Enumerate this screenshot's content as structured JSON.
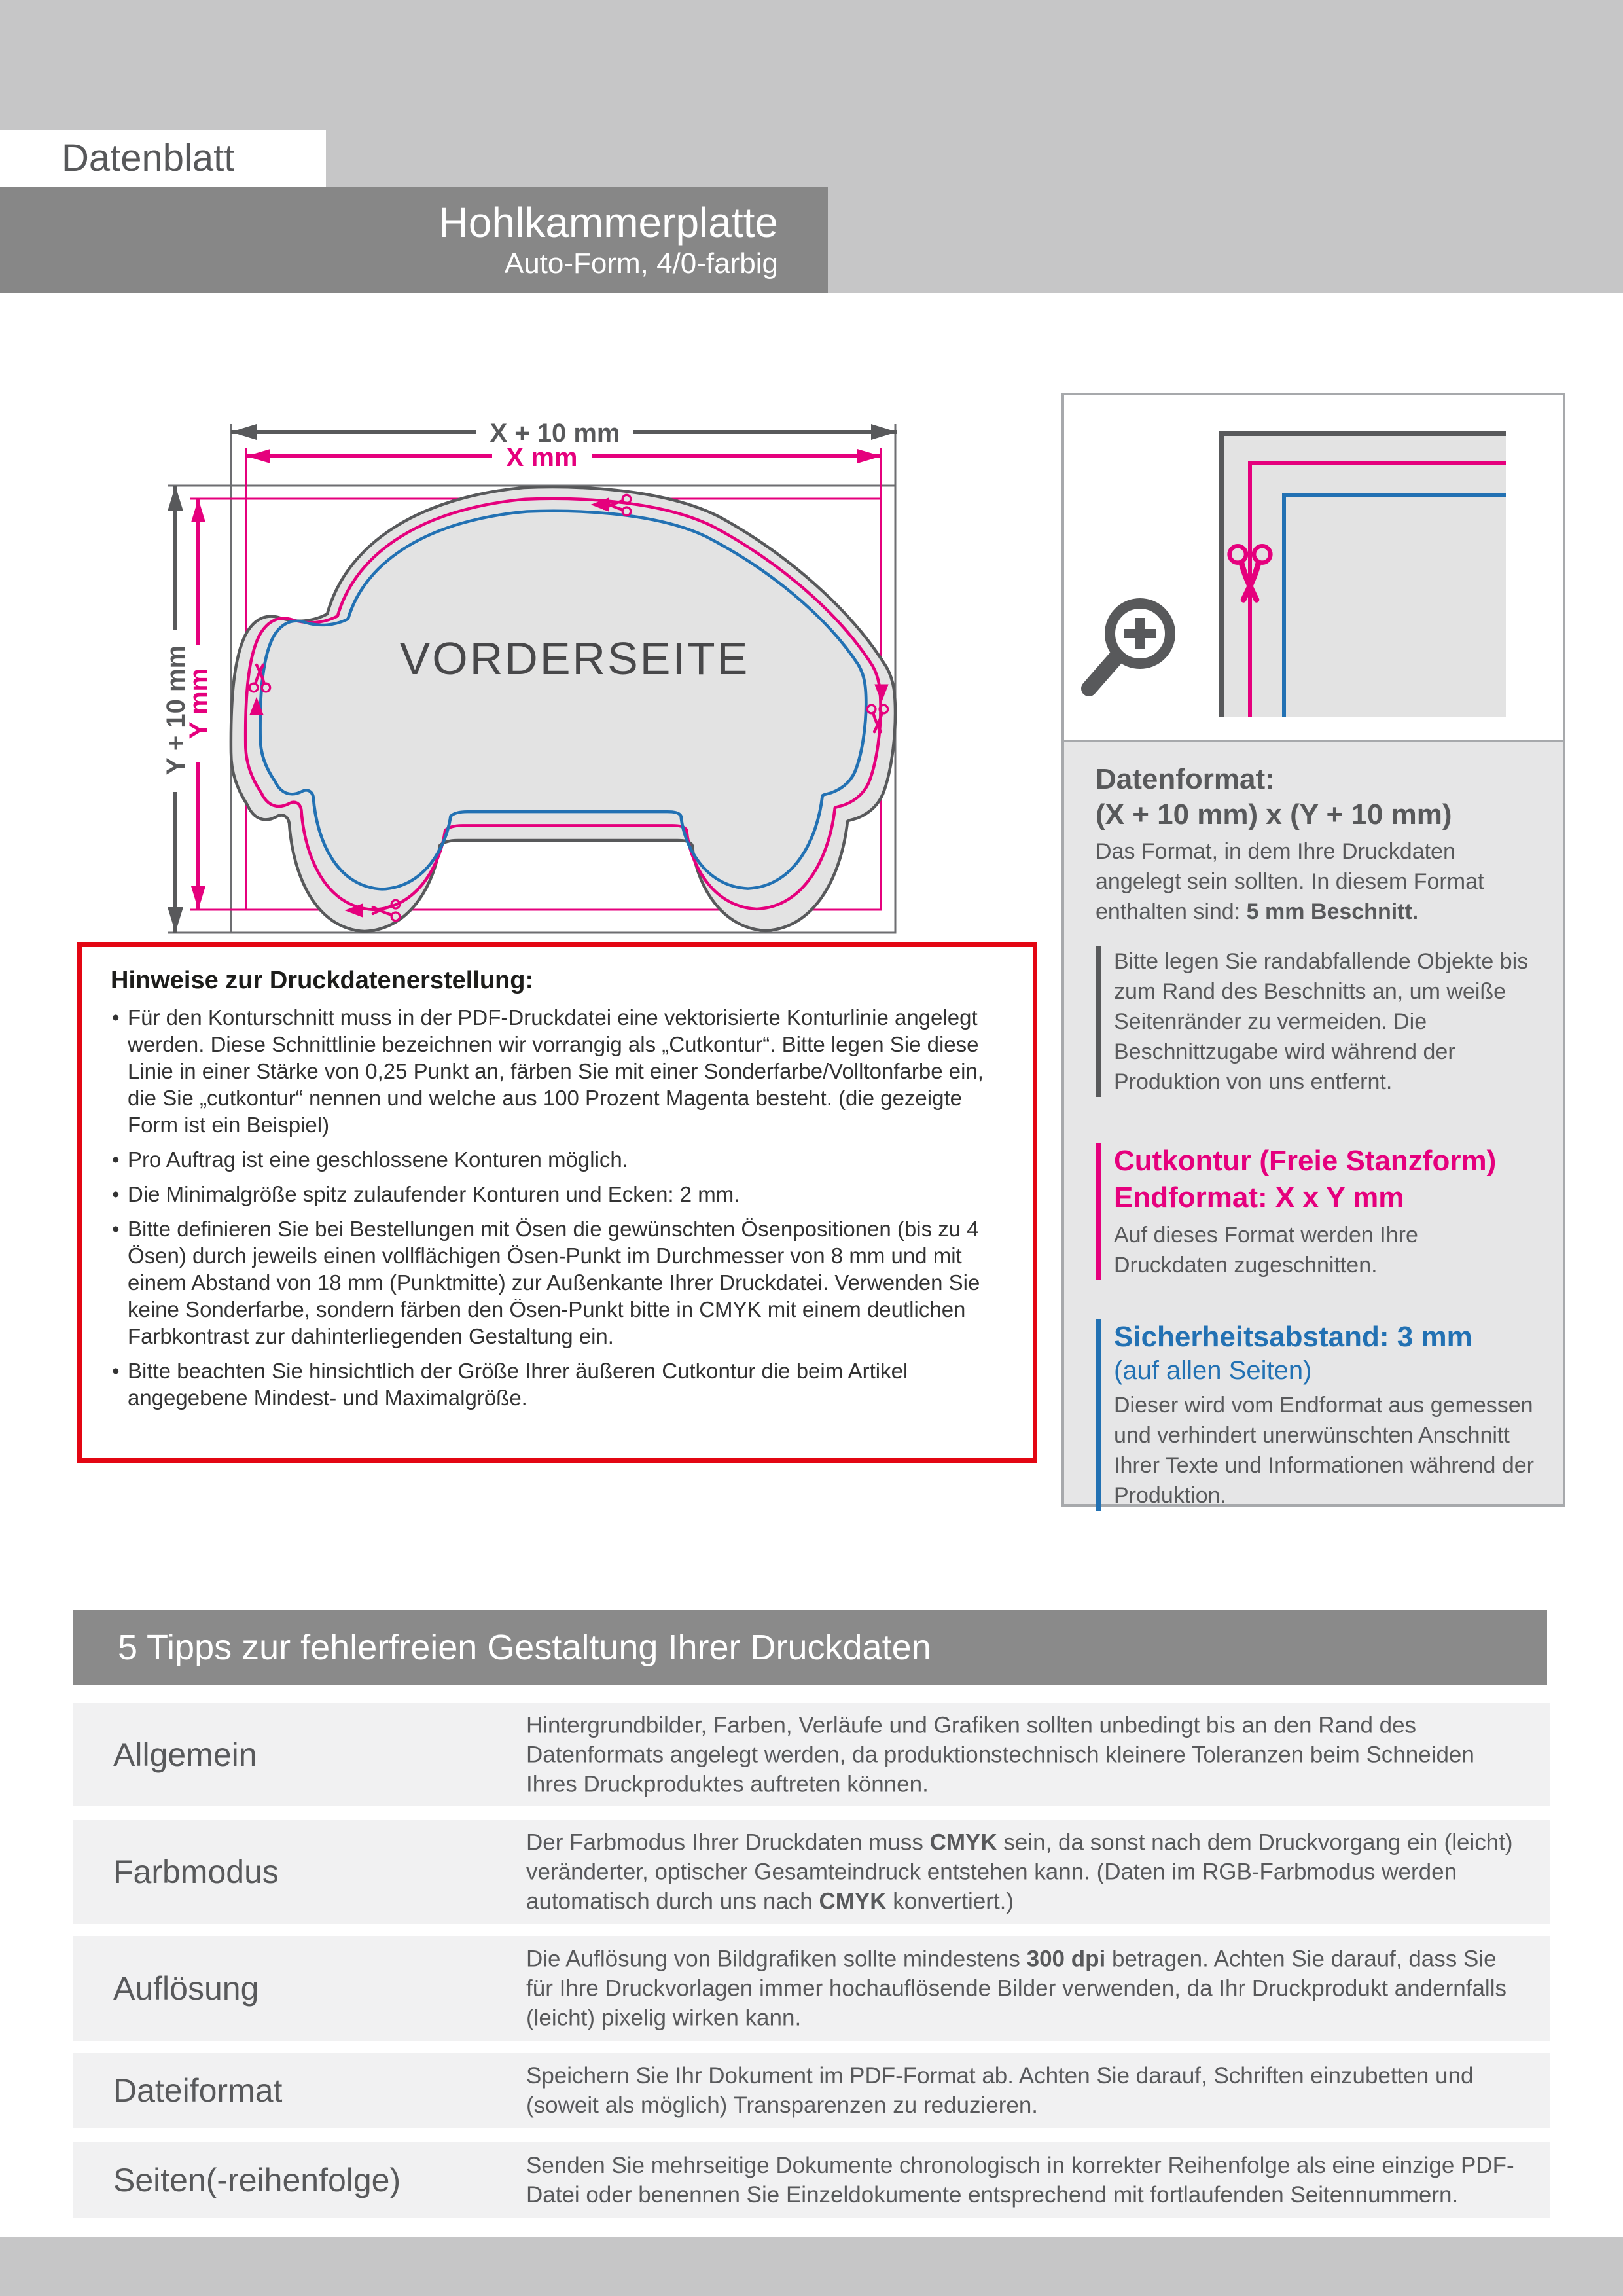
{
  "colors": {
    "magenta": "#e5007d",
    "blue": "#2271b3",
    "dark_gray": "#58595b",
    "band_gray": "#c6c6c7",
    "bar_gray": "#878787",
    "red": "#e30613",
    "sheet_fill": "#e3e3e3",
    "row_bg": "#f1f1f2"
  },
  "header": {
    "sheet_label": "Datenblatt",
    "product_title": "Hohlkammerplatte",
    "product_subtitle": "Auto-Form, 4/0-farbig"
  },
  "diagram": {
    "dim_x_outer": "X + 10 mm",
    "dim_x_inner": "X mm",
    "dim_y_outer": "Y + 10 mm",
    "dim_y_inner": "Y mm",
    "front_label": "VORDERSEITE"
  },
  "hinweise": {
    "title": "Hinweise zur Druckdatenerstellung:",
    "bullets": [
      "Für den Konturschnitt muss in der PDF-Druckdatei eine vektorisierte Konturlinie angelegt werden. Diese Schnittlinie bezeichnen wir vorrangig als „Cutkontur“. Bitte legen Sie diese Linie in einer Stärke von 0,25 Punkt an, färben Sie mit einer Sonderfarbe/Volltonfarbe ein, die Sie „cutkontur“ nennen und welche aus 100 Prozent Magenta besteht. (die gezeigte Form ist ein Beispiel)",
      "Pro Auftrag ist eine geschlossene Konturen möglich.",
      "Die Minimalgröße spitz zulaufender Konturen und Ecken: 2 mm.",
      "Bitte definieren Sie bei Bestellungen mit Ösen die gewünschten Ösenpositionen (bis zu 4 Ösen) durch jeweils einen vollflächigen Ösen-Punkt im Durchmesser von 8 mm und mit einem Abstand von 18 mm (Punktmitte) zur Außenkante Ihrer Druckdatei. Verwenden Sie keine Sonderfarbe, sondern färben den Ösen-Punkt bitte in CMYK mit einem deutlichen Farbkontrast zur dahinterliegenden Gestaltung ein.",
      "Bitte beachten Sie hinsichtlich der Größe Ihrer äußeren Cutkontur die beim Artikel angegebene Mindest- und Maximalgröße."
    ]
  },
  "panel": {
    "datenformat_title": "Datenformat:",
    "datenformat_format": "(X + 10 mm) x (Y + 10 mm)",
    "datenformat_body": [
      "Das Format, in dem Ihre Druckdaten angelegt sein sollten. In diesem Format enthalten sind: ",
      "5 mm Beschnitt."
    ],
    "bleed_note": "Bitte legen Sie randabfallende Objekte bis zum Rand des Beschnitts an, um weiße Seitenränder zu vermeiden. Die Beschnittzugabe wird während der Produktion von uns entfernt.",
    "cutkontur_title": "Cutkontur (Freie Stanzform)",
    "cutkontur_format": "Endformat: X x Y mm",
    "cutkontur_body": "Auf dieses Format werden Ihre Druckdaten zugeschnitten.",
    "safety_title": "Sicherheitsabstand: 3 mm",
    "safety_sub": "(auf allen Seiten)",
    "safety_body": "Dieser wird vom Endformat aus gemessen und verhindert unerwünschten Anschnitt Ihrer Texte und Informationen während der Produktion."
  },
  "tips": {
    "title": "5 Tipps zur fehlerfreien Gestaltung Ihrer Druckdaten",
    "rows": [
      {
        "label": "Allgemein",
        "segments": [
          "Hintergrundbilder, Farben, Verläufe und Grafiken sollten unbedingt bis an den Rand des Datenformats angelegt werden, da produktionstechnisch kleinere Toleranzen beim Schneiden Ihres Druckproduktes auftreten können."
        ]
      },
      {
        "label": "Farbmodus",
        "segments": [
          "Der Farbmodus Ihrer Druckdaten muss ",
          "CMYK",
          " sein, da sonst nach dem Druckvorgang ein (leicht) veränderter, optischer Gesamteindruck entstehen kann. (Daten im RGB-Farbmodus werden automatisch durch uns nach ",
          "CMYK",
          " konvertiert.)"
        ]
      },
      {
        "label": "Auflösung",
        "segments": [
          "Die Auflösung von Bildgrafiken sollte mindestens ",
          "300 dpi",
          " betragen. Achten Sie darauf, dass Sie für Ihre Druckvorlagen immer hochauflösende Bilder verwenden, da Ihr Druckprodukt andernfalls (leicht) pixelig wirken kann."
        ]
      },
      {
        "label": "Dateiformat",
        "segments": [
          "Speichern Sie Ihr Dokument im PDF-Format ab. Achten Sie darauf, Schriften einzubetten und (soweit als möglich) Transparenzen zu reduzieren."
        ]
      },
      {
        "label": "Seiten(-reihenfolge)",
        "segments": [
          "Senden Sie mehrseitige Dokumente chronologisch in korrekter Reihenfolge als eine einzige PDF-Datei oder benennen Sie Einzeldokumente entsprechend mit fortlaufenden Seitennummern."
        ]
      }
    ]
  }
}
